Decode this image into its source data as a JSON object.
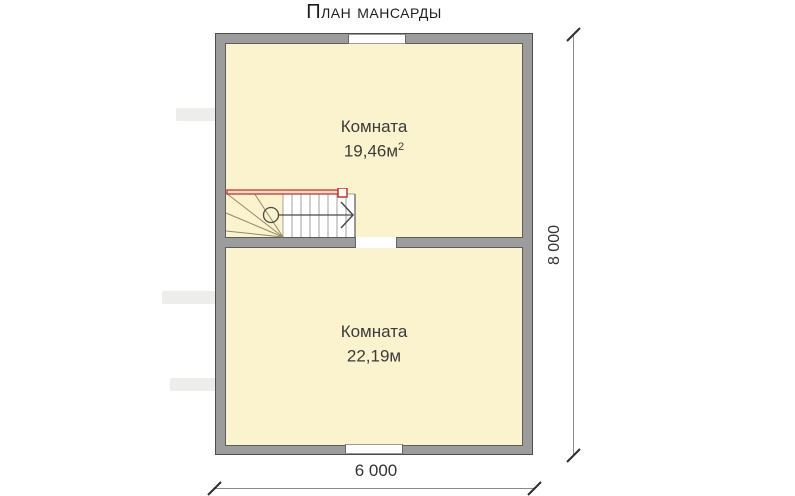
{
  "title": "План мансарды",
  "rooms": [
    {
      "label": "Комната",
      "area_value": "19,46м",
      "area_sup": "2"
    },
    {
      "label": "Комната",
      "area_value": "22,19м",
      "area_sup": ""
    }
  ],
  "dimensions": {
    "height_label": "8 000",
    "width_label": "6 000"
  },
  "colors": {
    "wall_fill": "#9c9c9c",
    "wall_outline": "#4d4d4d",
    "floor_fill": "#fbf3cd",
    "railing_red": "#c0392b",
    "stair_tread_fill": "#ffffff",
    "text": "#3b3b3b"
  },
  "icons": {
    "stair_direction": "chevron-right-icon",
    "stair_start": "circle-icon"
  }
}
